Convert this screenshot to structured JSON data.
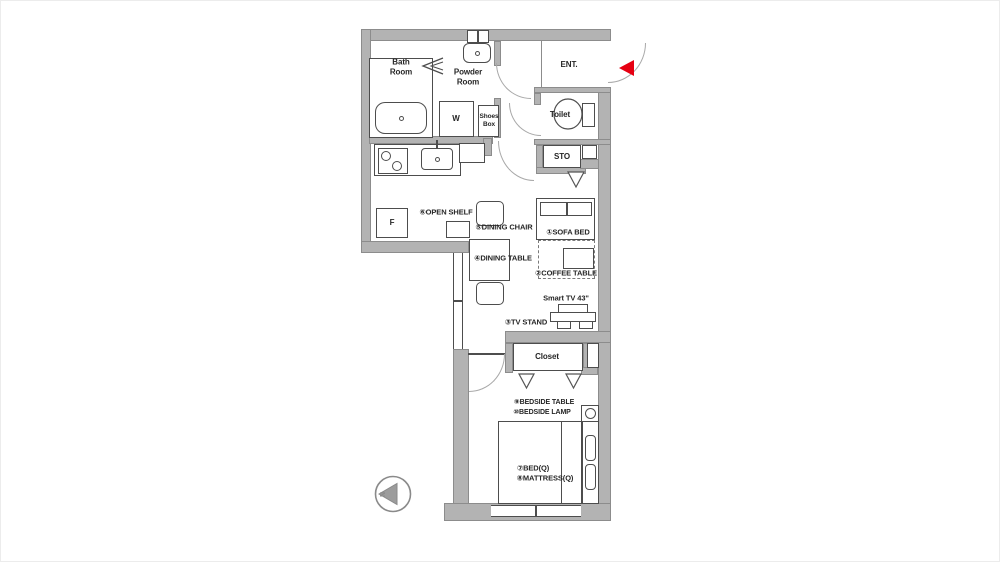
{
  "rooms": {
    "bath_room": "Bath\nRoom",
    "powder_room": "Powder\nRoom",
    "washer": "W",
    "shoes_box": "Shoes\nBox",
    "toilet": "Toilet",
    "entrance": "ENT.",
    "storage": "STO",
    "fridge": "F",
    "closet": "Closet"
  },
  "furniture": {
    "sofa_bed": "①SOFA BED",
    "coffee_table": "②COFFEE TABLE",
    "tv_stand": "③TV STAND",
    "dining_table": "④DINING TABLE",
    "dining_chair": "⑤DINING CHAIR",
    "open_shelf": "⑥OPEN SHELF",
    "bed": "⑦BED(Q)",
    "mattress": "⑧MATTRESS(Q)",
    "bedside_table": "⑨BEDSIDE TABLE",
    "bedside_lamp": "⑩BEDSIDE LAMP",
    "smart_tv": "Smart TV 43\""
  },
  "compass": {
    "north": "N"
  },
  "colors": {
    "wall": "#b3b3b3",
    "line": "#4d4d4d",
    "entrance_arrow": "#e60012"
  }
}
